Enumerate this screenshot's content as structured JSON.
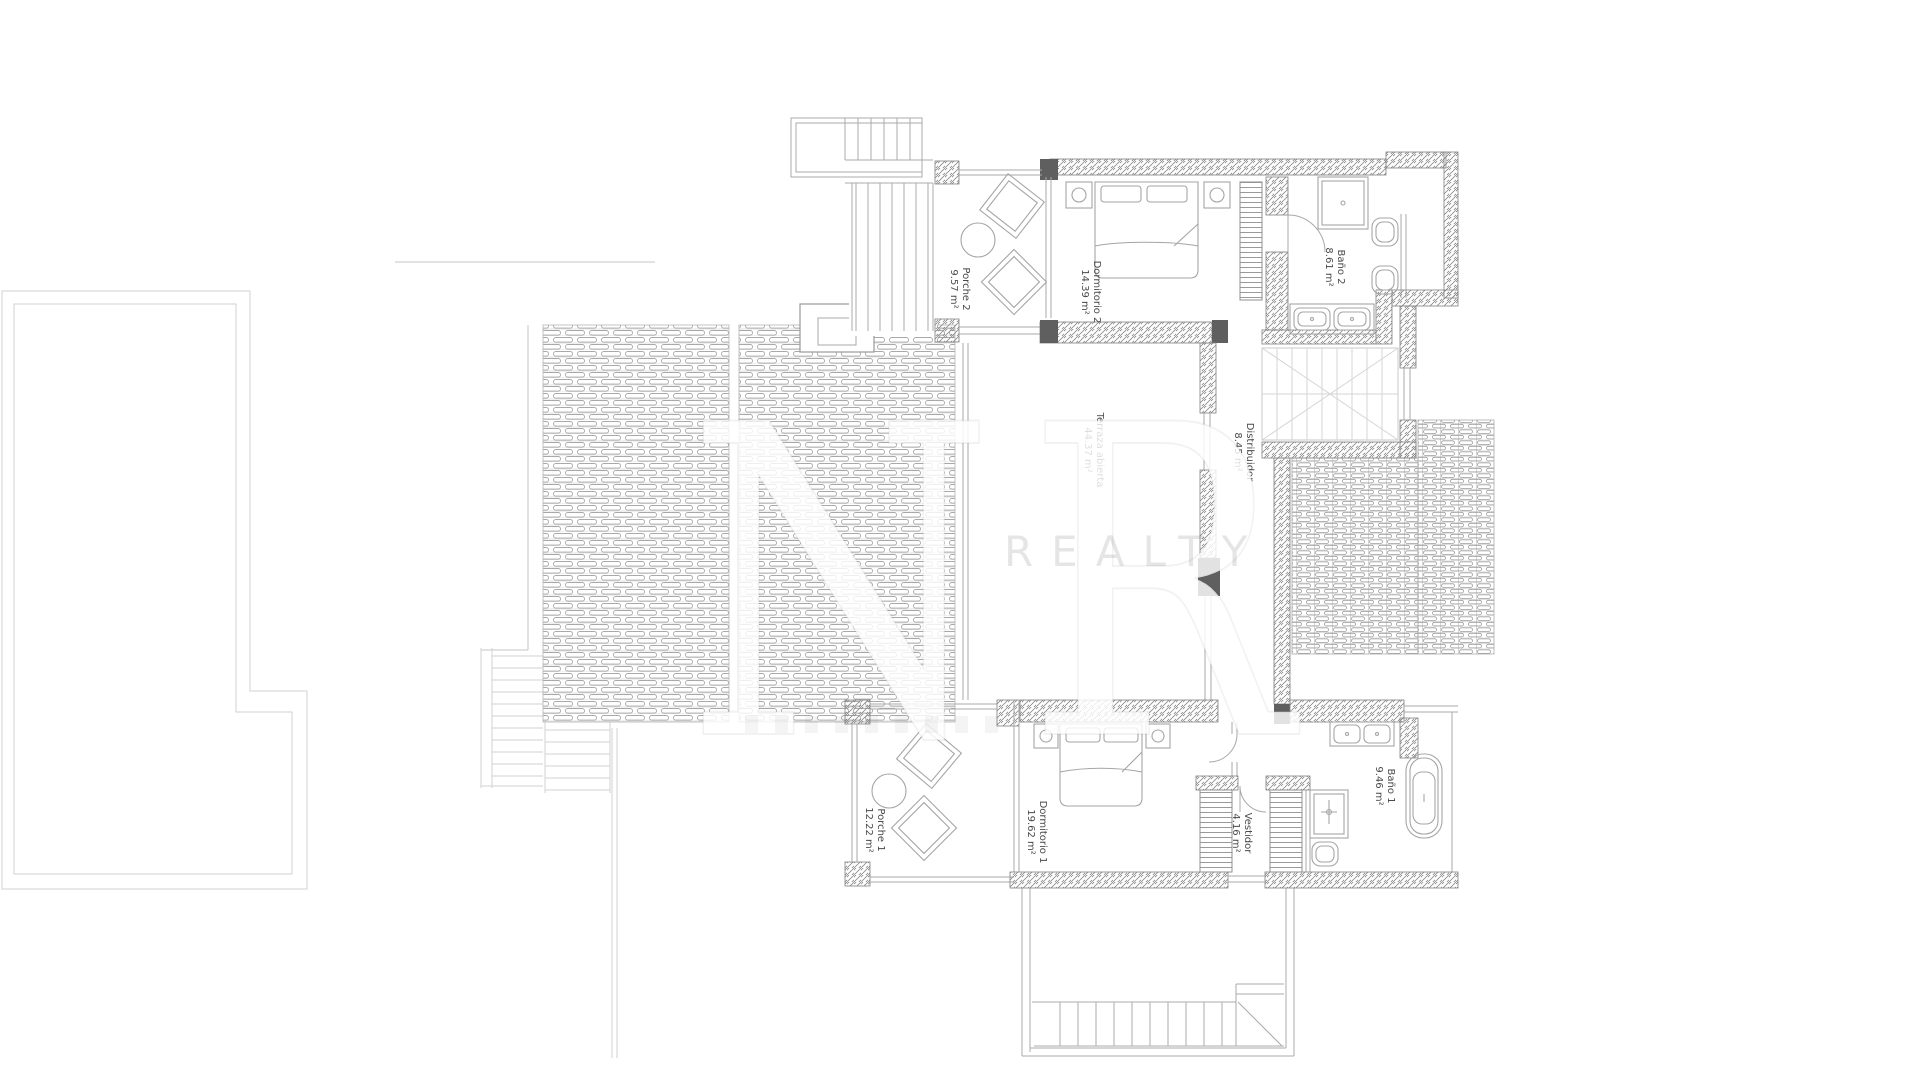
{
  "document": {
    "type": "architectural-floor-plan",
    "background": "#ffffff"
  },
  "watermark": {
    "line1": "NR",
    "line2": "REALTY"
  },
  "rooms": [
    {
      "id": "porche-2",
      "name": "Porche 2",
      "area": "9.57 m²"
    },
    {
      "id": "dormitorio-2",
      "name": "Dormitorio 2",
      "area": "14.39 m²"
    },
    {
      "id": "bano-2",
      "name": "Baño 2",
      "area": "8.61 m²"
    },
    {
      "id": "terraza-abierta",
      "name": "Terraza abierta",
      "area": "44.37 m²"
    },
    {
      "id": "distribuidor",
      "name": "Distribuidor",
      "area": "8.45 m²"
    },
    {
      "id": "porche-1",
      "name": "Porche 1",
      "area": "12.22 m²"
    },
    {
      "id": "dormitorio-1",
      "name": "Dormitorio 1",
      "area": "19.62 m²"
    },
    {
      "id": "vestidor",
      "name": "Vestidor",
      "area": "4.16 m²"
    },
    {
      "id": "bano-1",
      "name": "Baño 1",
      "area": "9.46 m²"
    }
  ],
  "colors": {
    "plan_line": "#9a9a9a",
    "wall_hatch": "#8a8a8a",
    "pillar_fill": "#5f5f5f",
    "label_text": "#4a4a4a",
    "watermark_gray": "#d9d9d9"
  }
}
